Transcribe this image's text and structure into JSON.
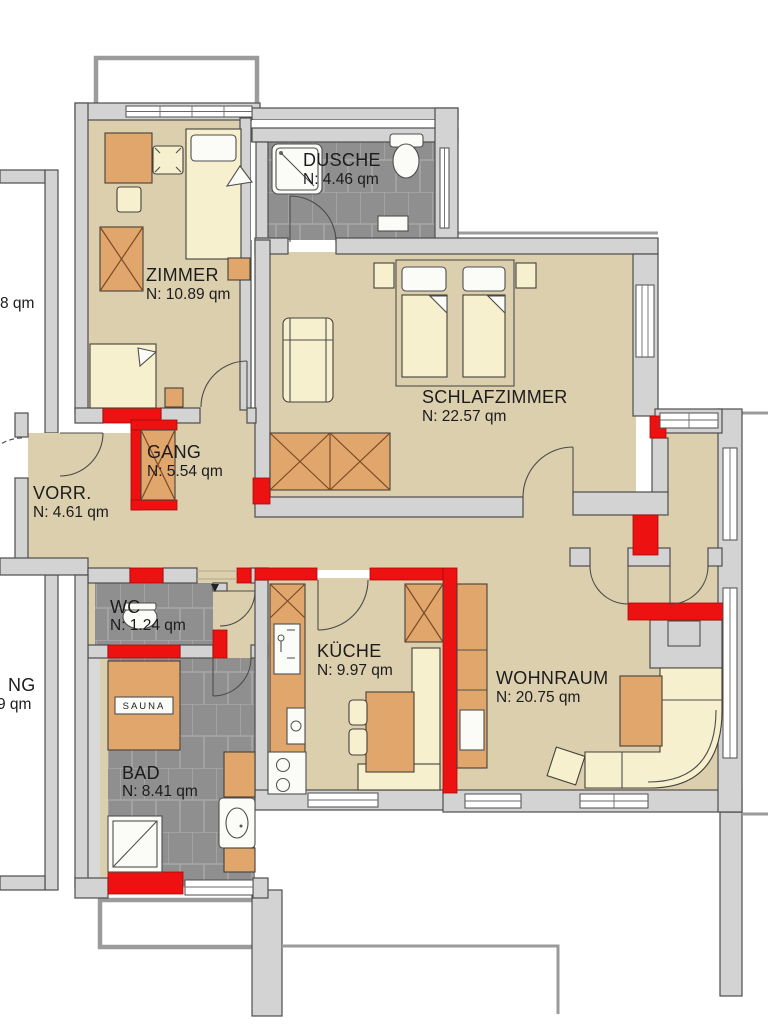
{
  "plan": {
    "type": "apartment-floor-plan",
    "unit_suffix": "qm",
    "rooms": [
      {
        "key": "zimmer",
        "label": "ZIMMER",
        "area": "N: 10.89 qm"
      },
      {
        "key": "dusche",
        "label": "DUSCHE",
        "area": "N: 4.46 qm"
      },
      {
        "key": "schlafzimmer",
        "label": "SCHLAFZIMMER",
        "area": "N: 22.57 qm"
      },
      {
        "key": "gang",
        "label": "GANG",
        "area": "N: 5.54 qm"
      },
      {
        "key": "vorraum",
        "label": "VORR.",
        "area": "N: 4.61 qm"
      },
      {
        "key": "wc",
        "label": "WC",
        "area": "N: 1.24 qm"
      },
      {
        "key": "kueche",
        "label": "KÜCHE",
        "area": "N: 9.97 qm"
      },
      {
        "key": "wohnraum",
        "label": "WOHNRAUM",
        "area": "N: 20.75 qm"
      },
      {
        "key": "bad",
        "label": "BAD",
        "area": "N: 8.41 qm"
      }
    ],
    "fixtures": {
      "sauna_label": "SAUNA"
    },
    "neighbor_partial_labels": {
      "top_left": "8 qm",
      "bottom_left_line1": "NG",
      "bottom_left_line2": "9 qm"
    },
    "colors": {
      "floor_beige": "#dccfae",
      "wall_gray": "#d3d3d3",
      "wall_outline": "#4e4e4e",
      "new_wall_red": "#ee1111",
      "tile_gray": "#8f8f8f",
      "furniture_orange": "#e1a66b",
      "furniture_cream": "#f7f0cf",
      "fixture_white": "#fbfbf8",
      "text": "#1c1c1c"
    }
  }
}
